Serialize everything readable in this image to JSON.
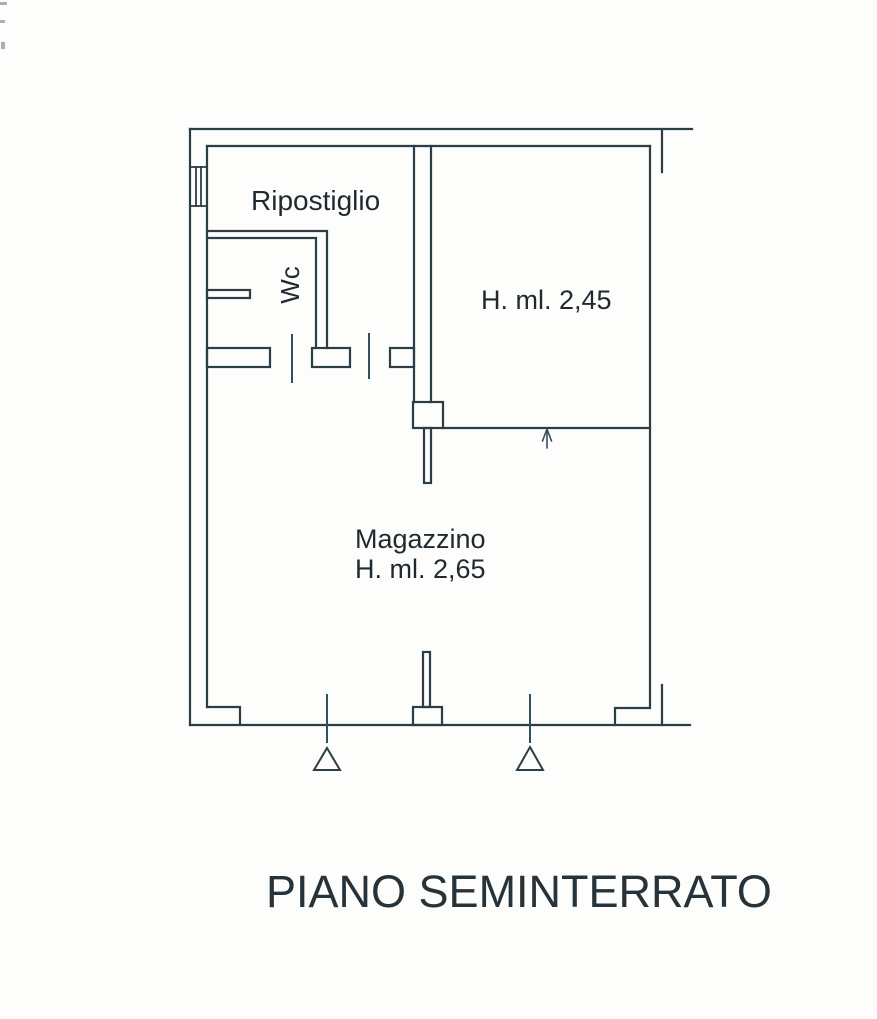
{
  "title": "PIANO SEMINTERRATO",
  "rooms": [
    {
      "name": "Ripostiglio",
      "height_label": ""
    },
    {
      "name": "Wc",
      "height_label": ""
    },
    {
      "name": "",
      "height_label": "H. ml. 2,45"
    },
    {
      "name": "Magazzino",
      "height_label": "H. ml. 2,65"
    }
  ],
  "symbols": {
    "window": "window-hatch",
    "entrance_arrow": "arrow-up",
    "door_marker_left": "triangle-outline",
    "door_marker_right": "triangle-outline"
  },
  "colors": {
    "ink": "#2b3e46",
    "text": "#1f2a30",
    "paper": "#fdfdfc"
  }
}
